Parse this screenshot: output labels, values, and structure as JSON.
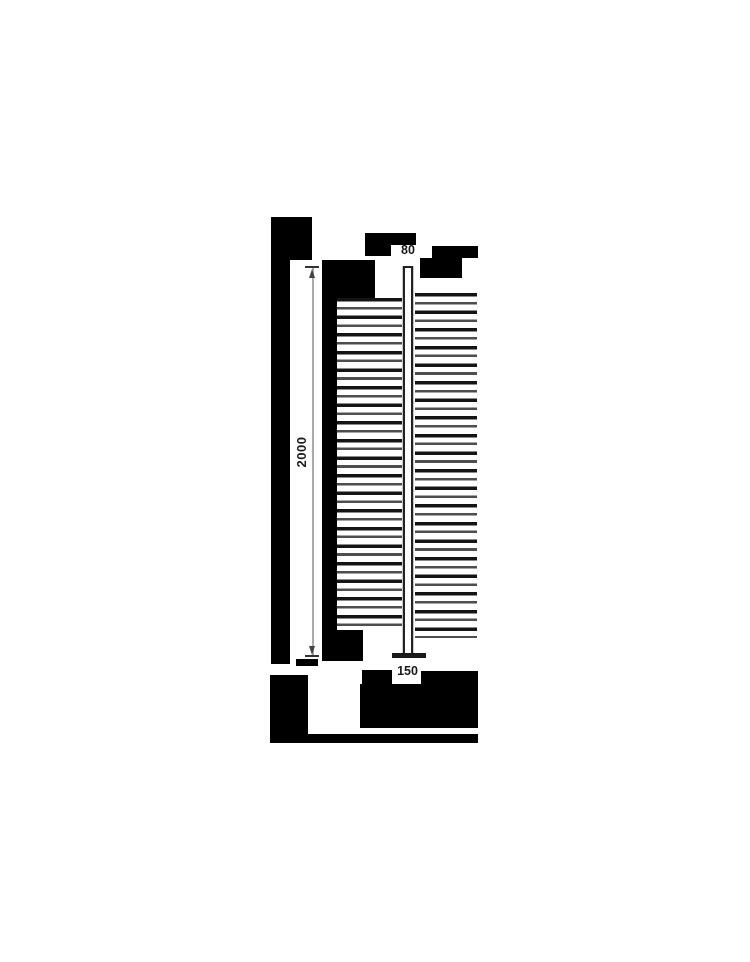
{
  "page": {
    "background": "#ffffff",
    "description": "Technical dimension drawing of a vertical post with horizontal rails; surrounding text redacted with black blocks"
  },
  "drawing": {
    "labels": {
      "post_width": "80",
      "post_height": "2000",
      "base_width": "150"
    },
    "units_shown": false,
    "rails": {
      "left_line_count": 38,
      "right_line_count": 39,
      "line_pitch_px": 8.8
    },
    "colors": {
      "redaction_block": "#000000",
      "rail_dark": "#141414",
      "rail_gray": "#4d4d4d",
      "post_outline": "#222222",
      "base_plate": "#1a1a1a",
      "dimension_line": "#aaaaaa",
      "dimension_marks": "#333333",
      "label_text": "#1a1a1a"
    }
  }
}
